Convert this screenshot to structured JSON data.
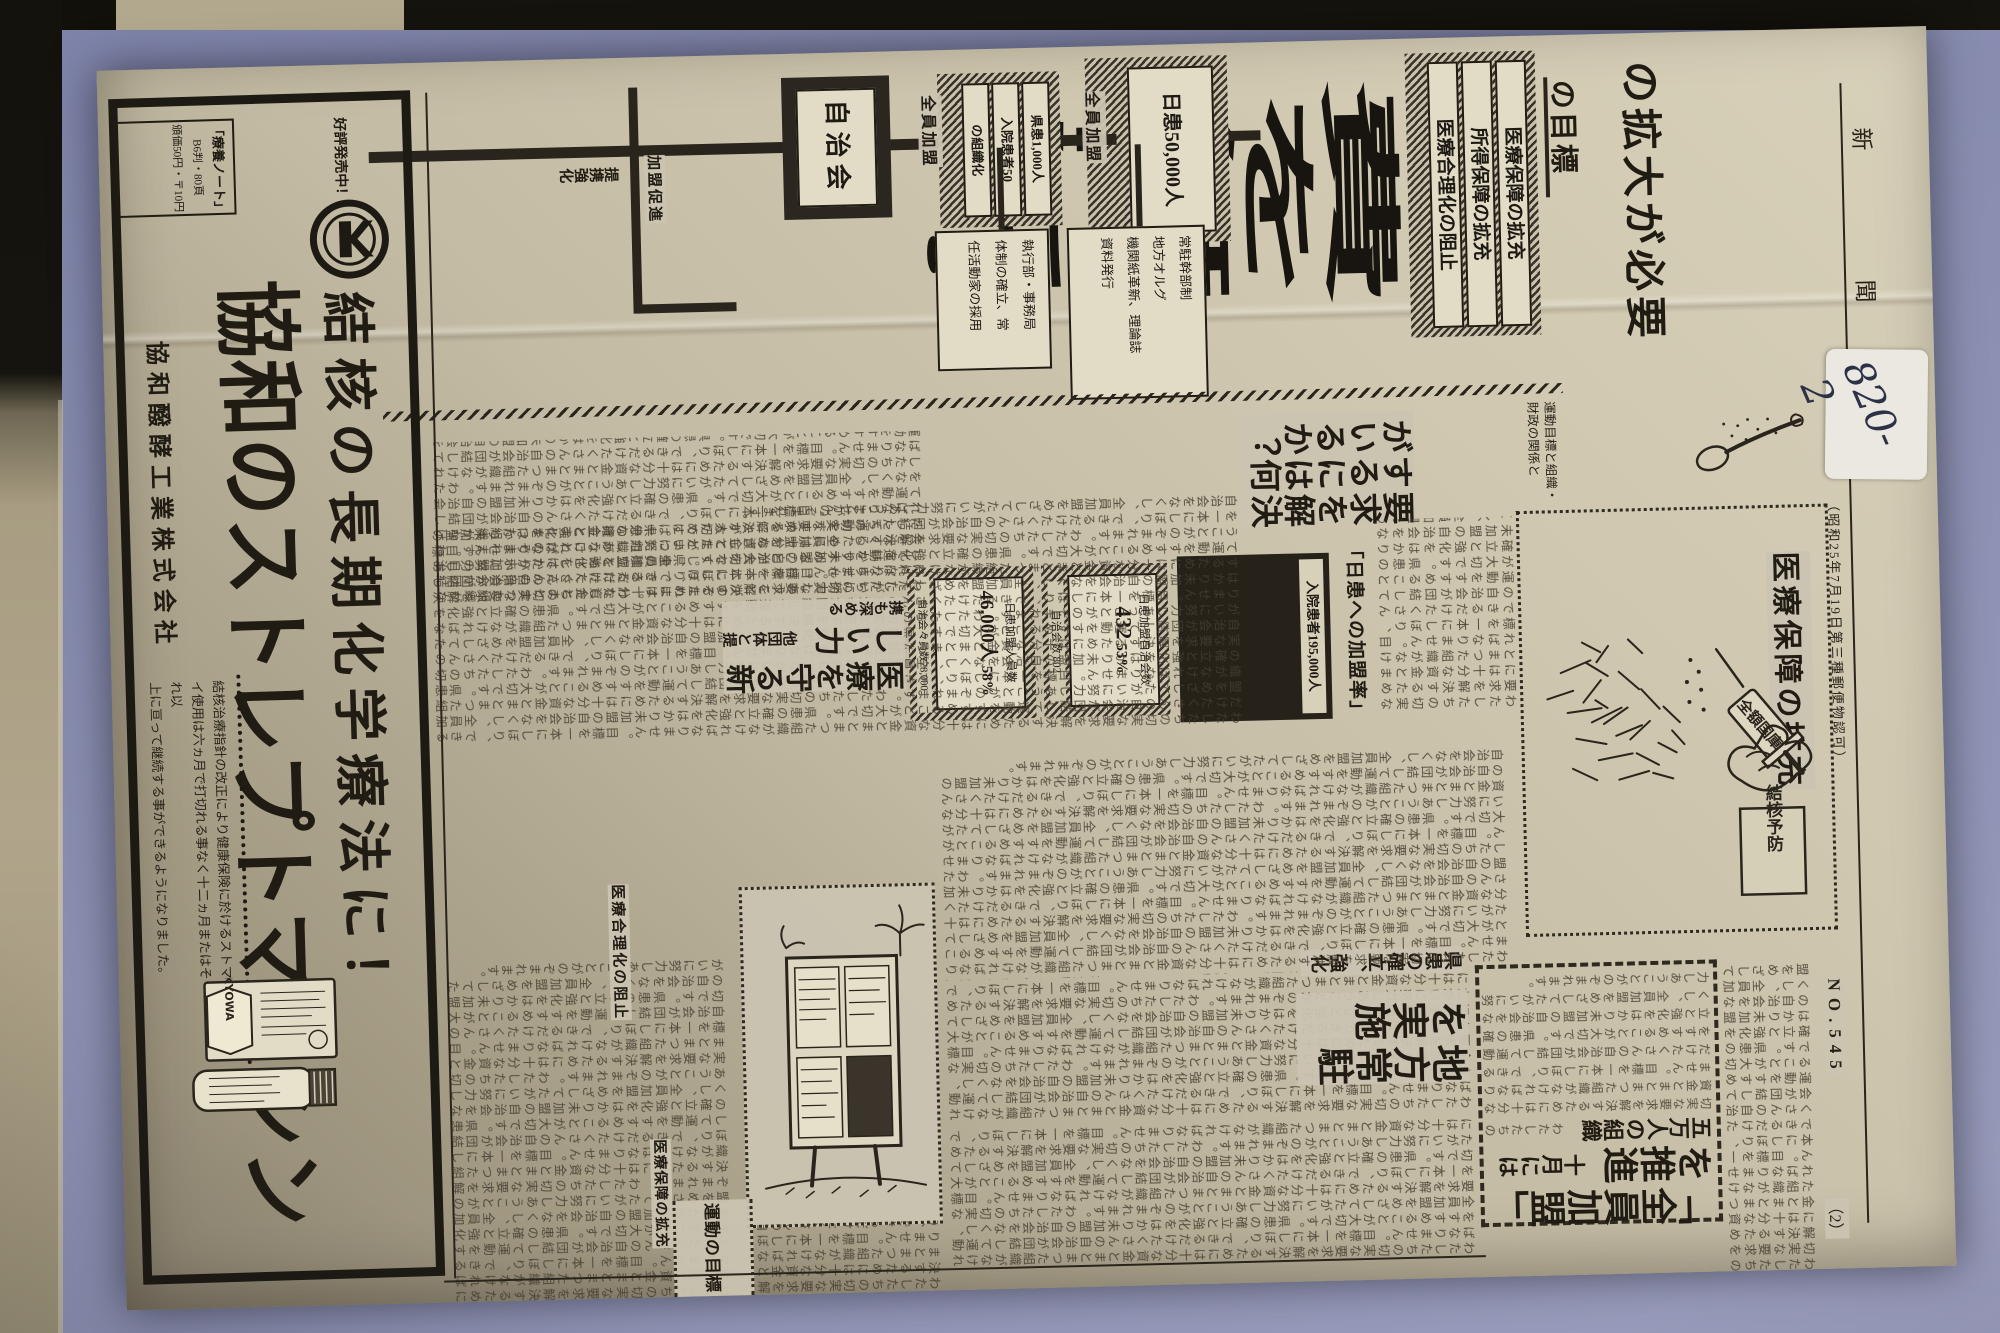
{
  "masthead": {
    "title_left": "新",
    "title_right": "聞",
    "registration_note": "（昭和25年7月19日第三種郵便物認可）",
    "issue_number": "NO.545",
    "page_number": "（2）",
    "archival_label": "820-2"
  },
  "lead": {
    "headline": "費を無料に！",
    "subheadline": "の拡大が必要",
    "section_label": "の目標",
    "kicker_line1": "運動目標と組織・",
    "kicker_line2": "財政の関係と"
  },
  "goals": {
    "items": [
      "医療保障の拡充",
      "所得保障の拡充",
      "医療合理化の阻止"
    ]
  },
  "diagram": {
    "top_box_label": "日患50,000人",
    "link1": "全員加盟",
    "mid_box_lines": [
      "県患1,000人",
      "入院患者50",
      "の組織化"
    ],
    "link2": "全員加盟",
    "bottom_box_label": "自治会",
    "branch_label_promotion": "加盟促進",
    "branch_label_cooperation": "提携強化",
    "org_box_lines": [
      "常駐幹部制",
      "地方オルグ",
      "機関紙革新、理論誌",
      "資料発行"
    ],
    "exec_box_lines": [
      "執行部・事務局",
      "体制の確立、常",
      "任活動家の採用"
    ]
  },
  "articles": {
    "q_headline": "要求を解決するには何がいるか？",
    "zenin": {
      "headline": "「全員加盟」を推進",
      "sub": "十月には五万人の組織"
    },
    "chihou": {
      "headline": "地方常駐を実施",
      "sub": "県患の確立、強化"
    },
    "mamoru": {
      "headline": "医療を守る新しい力",
      "sub": "他団体と提携も深める"
    },
    "undou": {
      "title": "運動の目標",
      "sub1": "医療保障の拡充",
      "sub2": "医療合理化の阻止"
    }
  },
  "charts": {
    "heading": "「日患への加盟率」",
    "black_box_label": "入院患者195,000人",
    "box_a": {
      "line": "日患加盟自治会数",
      "value": "432",
      "rate": "53%",
      "outer": "自治会数 802"
    },
    "box_b": {
      "line": "日患加盟人員数",
      "value": "46,000人",
      "rate": "58%",
      "outer": "自治会々員数78,000"
    }
  },
  "chart_data": {
    "type": "table",
    "title": "「日患への加盟率」",
    "rows": [
      {
        "label": "入院患者",
        "value": 195000,
        "unit": "人"
      },
      {
        "label": "自治会数",
        "total": 802,
        "member_label": "日患加盟自治会数",
        "member": 432,
        "rate_percent": 53
      },
      {
        "label": "自治会々員数",
        "total": 78000,
        "member_label": "日患加盟人員数",
        "member": 46000,
        "rate_percent": 58
      }
    ]
  },
  "cartoons": {
    "syringe": {
      "caption": "医療保障の拡充",
      "syringe_label": "全額国庫",
      "cuff_label": "結核予防"
    }
  },
  "ad": {
    "promo": "好評発売中！",
    "note_line1": "「療養ノート」",
    "note_line2": "B6判・80頁",
    "note_line3": "頒価50円・〒10円",
    "slogan": "結核の長期化学療法に！",
    "brand": "協和のストレプトマイシン",
    "copy_line1": "結核治療指針の改正により健康保険に於けるストマ",
    "copy_line2": "イ使用は六ヵ月で打切れる事なく十二ヵ月またはそれ以",
    "copy_line3": "上に亘って継続する事ができるようになりました。",
    "company": "協和醱酵工業株式会社",
    "package": {
      "brand_en": "KYOWA",
      "label_text": "CRYSTALLINE DIHYDRO STREPTOMYCIN SULFATE"
    }
  },
  "filler": {
    "body_text": "わたしたちの切実な要求を解決するためには十分な資金とまとまつた組織がなければなりません。目標を一本にしぼり、できるだけたくさんの自治会が団結して運動をすすめることが大切です。県患の確立と強化をはかり未加盟の自治会をなくし、全員加盟をめざしてたがいに努力しあうことがのぞまれます。"
  }
}
